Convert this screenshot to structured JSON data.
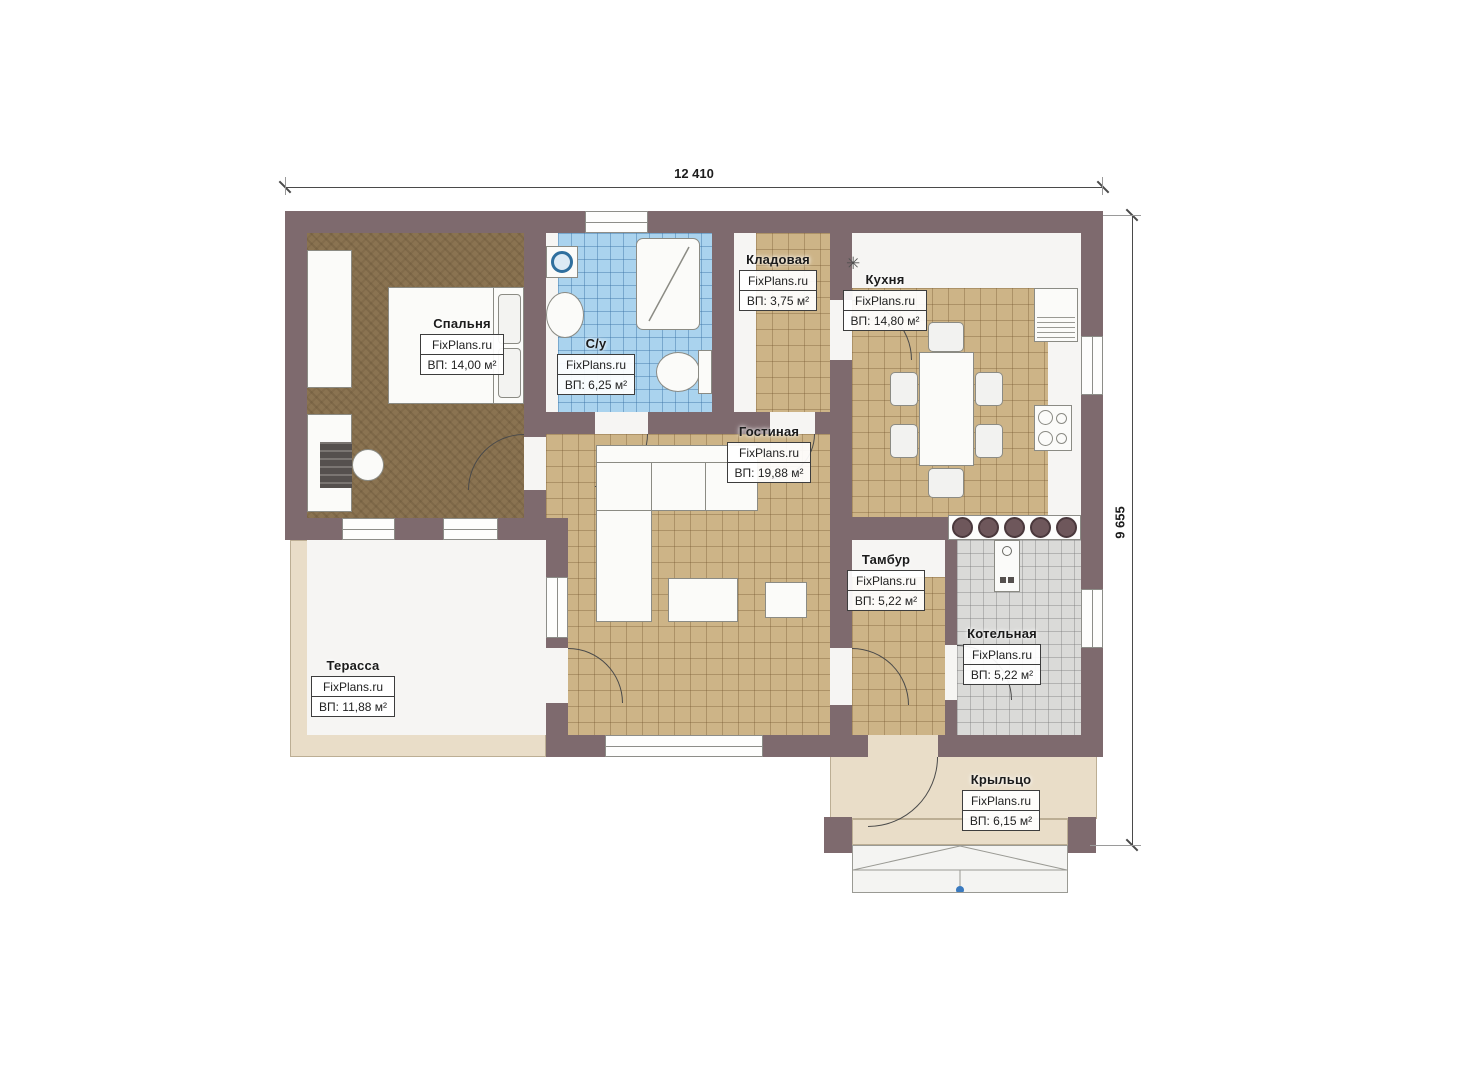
{
  "plan": {
    "dimensions": {
      "width_label": "12 410",
      "height_label": "9 655"
    },
    "watermark": "FixPlans.ru",
    "rooms": [
      {
        "id": "bedroom",
        "name": "Спальня",
        "area": "ВП: 14,00 м²"
      },
      {
        "id": "bathroom",
        "name": "С/у",
        "area": "ВП: 6,25 м²"
      },
      {
        "id": "storage",
        "name": "Кладовая",
        "area": "ВП: 3,75 м²"
      },
      {
        "id": "kitchen",
        "name": "Кухня",
        "area": "ВП: 14,80 м²"
      },
      {
        "id": "living-room",
        "name": "Гостиная",
        "area": "ВП: 19,88 м²"
      },
      {
        "id": "vestibule",
        "name": "Тамбур",
        "area": "ВП: 5,22 м²"
      },
      {
        "id": "boiler-room",
        "name": "Котельная",
        "area": "ВП: 5,22 м²"
      },
      {
        "id": "terrace",
        "name": "Терасса",
        "area": "ВП: 11,88 м²"
      },
      {
        "id": "porch",
        "name": "Крыльцо",
        "area": "ВП: 6,15 м²"
      }
    ],
    "symbols": {
      "kitchen_light": "✳"
    },
    "colors": {
      "wall": "#7e6a6e",
      "floor_tile_tan": "#cdb487",
      "floor_bedroom_brown": "#8a7351",
      "floor_bath_blue": "#aad3ee",
      "floor_boiler_gray": "#dadad8",
      "outdoor_beige": "#e9ddc8",
      "step_marker_blue": "#3a7abf"
    }
  }
}
